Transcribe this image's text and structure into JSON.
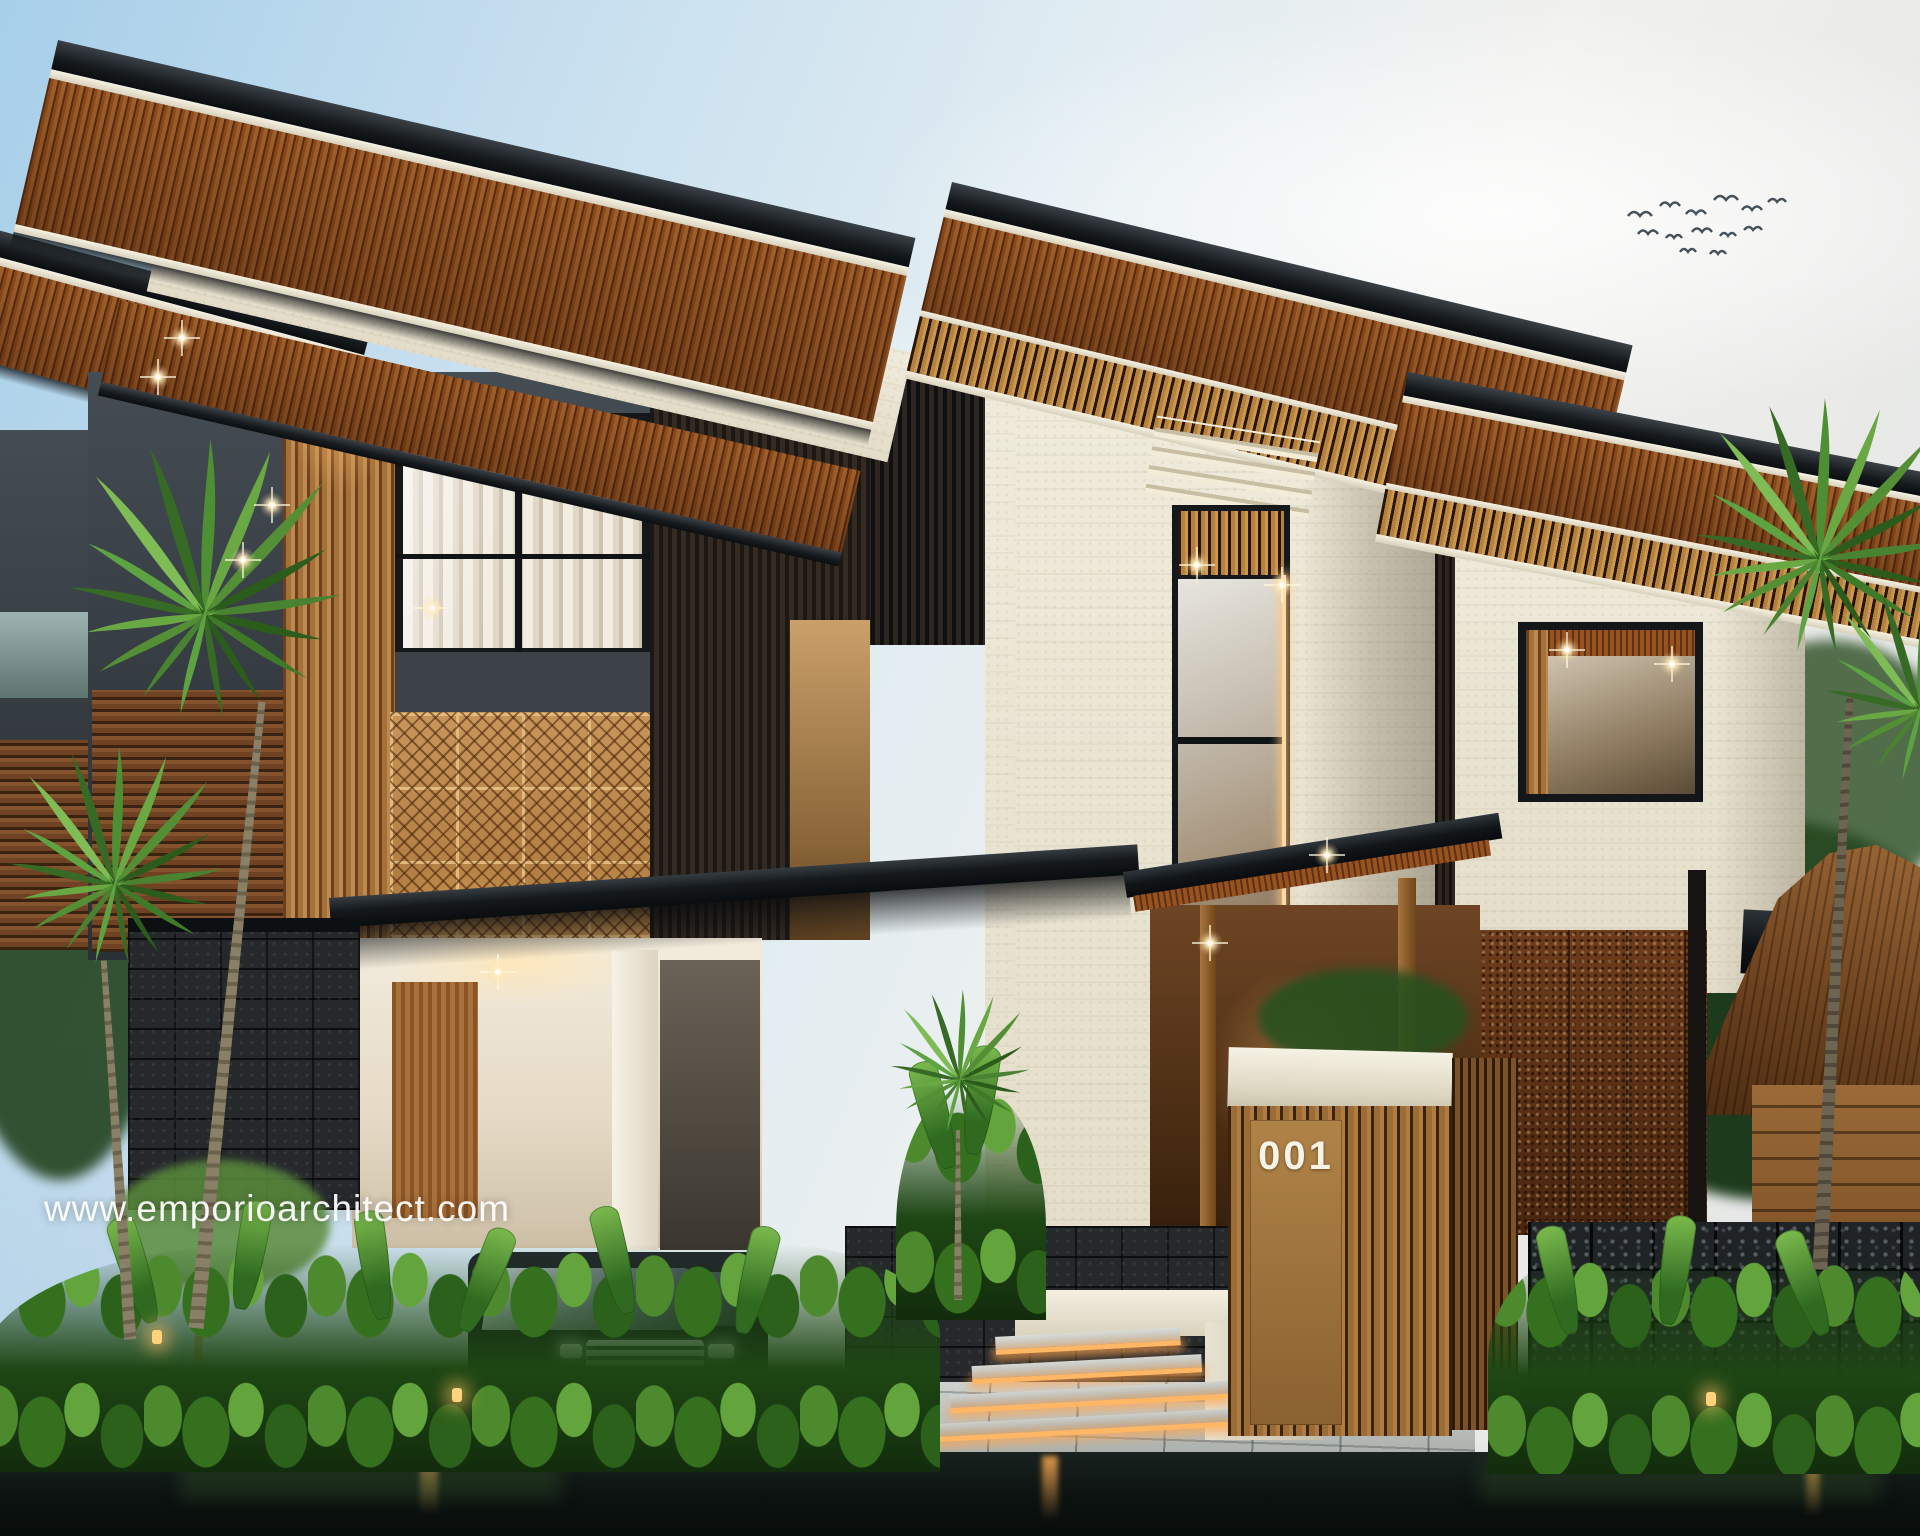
{
  "meta": {
    "type": "architectural-exterior-render",
    "description": "Dusk photorealistic rendering of a modern tropical 2-3 storey villa: dark flat overhanging roofs with warm wood-slat soffits and downlights, cream travertine towers, charcoal panels, carved gold ornament wall, vertical wood slat screens, lava-stone and gabion fences, carport with black MPV, LED-lit entry steps, reflecting pond, tropical palms and heliconia beds, birds in the sky"
  },
  "overlay": {
    "watermark": "www.emporioarchitect.com"
  },
  "house": {
    "number_sign": "001"
  },
  "icons": {
    "birds": "birds-flock-icon",
    "downlight": "star-flare-icon",
    "garden_light": "garden-light-icon",
    "palm": "fan-palm-icon"
  },
  "palette": {
    "sky_blue": "#a7cfe9",
    "sky_white": "#f1f1ee",
    "roof_dark": "#171b1e",
    "soffit_wood": "#96521f",
    "slat_wood": "#b5813f",
    "stone_cream": "#ebe5d3",
    "panel_charcoal": "#384046",
    "ornament_gold": "#c08c49",
    "rust_screen": "#5e3115",
    "lava_stone": "#26292c",
    "foliage_green": "#3c7a28",
    "water_dark": "#101815",
    "warm_light": "#ffd27c",
    "glass_warm": "#d6ccbc"
  }
}
